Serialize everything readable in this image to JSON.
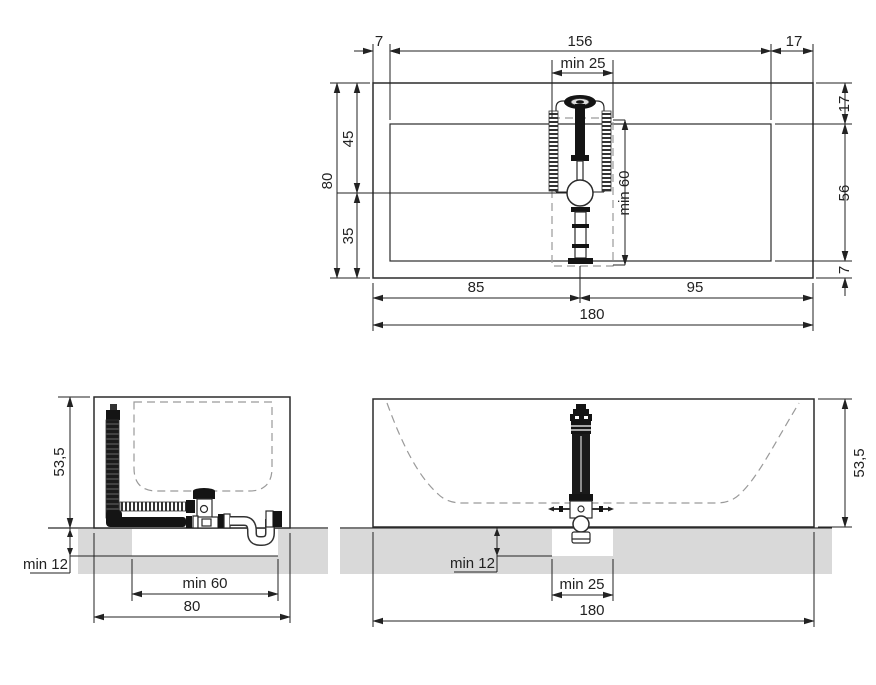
{
  "views": {
    "plan": {
      "margin_left": "7",
      "basin_length": "156",
      "margin_right": "17",
      "recess_min_width": "min 25",
      "rim_top": "17",
      "basin_width": "56",
      "rim_bottom": "7",
      "overall_width": "80",
      "mixer_offset_top": "45",
      "mixer_offset_bottom": "35",
      "recess_min_length": "min 60",
      "mixer_from_left": "85",
      "mixer_from_right": "95",
      "overall_length": "180"
    },
    "side": {
      "height": "53,5",
      "recess_min_depth": "min 12",
      "recess_min_width": "min  60",
      "overall_width": "80"
    },
    "front": {
      "height": "53,5",
      "recess_min_depth": "min 12",
      "recess_min_width": "min  25",
      "overall_length": "180"
    }
  },
  "colors": {
    "line": "#2b2b2b",
    "text": "#222222",
    "floor_screed": "#d9d9d9",
    "hidden_line": "#9a9a9a",
    "fixture_dark": "#141414",
    "background": "#ffffff"
  }
}
